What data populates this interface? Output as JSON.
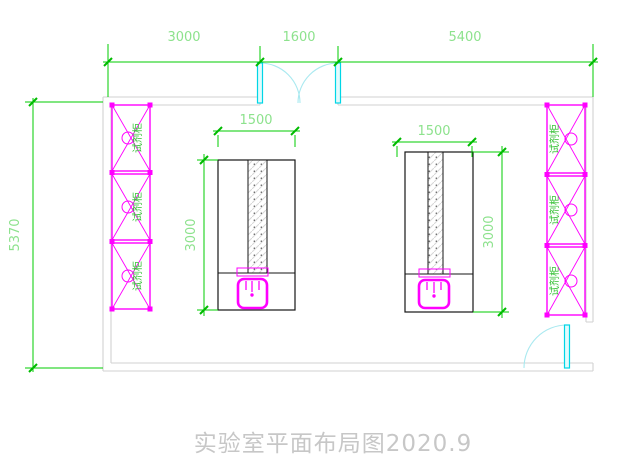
{
  "title": "实验室平面布局图2020.9",
  "dimensions": {
    "top_segments": [
      "3000",
      "1600",
      "5400"
    ],
    "overall_height": "5370",
    "bench_left": {
      "width": "1500",
      "length": "3000"
    },
    "bench_right": {
      "width": "1500",
      "length": "3000"
    }
  },
  "cabinets": {
    "label": "试剂柜"
  },
  "colors": {
    "dimension_green": "#00cc00",
    "fixture_magenta": "#ff00ff",
    "door_cyan": "#00d6e6",
    "wall_gray": "#d2d2d2",
    "title_gray": "#c7c7c7"
  }
}
